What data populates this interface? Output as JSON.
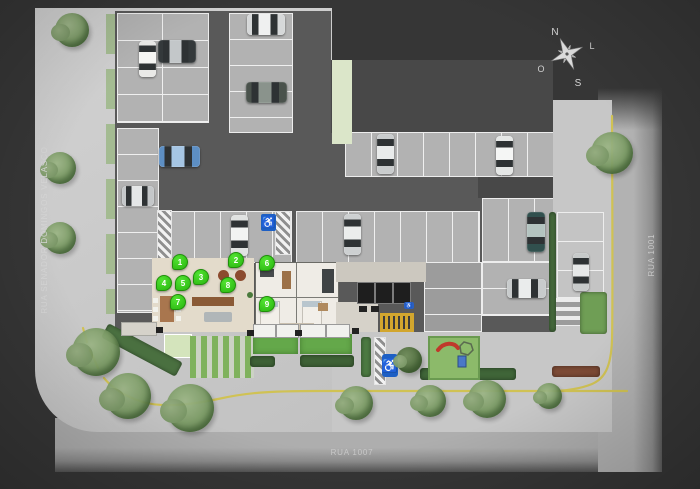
{
  "streets": {
    "left": "RUA SENADOR DOMINGOS VELASCO",
    "bottom": "RUA 1007",
    "right": "RUA 1001"
  },
  "compass": {
    "north": "N",
    "south": "S",
    "east": "L",
    "west": "O"
  },
  "icons": {
    "accessibility": "♿"
  },
  "colors": {
    "marker_green": "#35c91e",
    "accessible_blue": "#1d5fc4",
    "lane_yellow": "#d0c254",
    "stair_yellow": "#d2a62e",
    "lawn_green": "#64a84a",
    "slide_red": "#c0392b",
    "building_gray": "#595959",
    "sidewalk_gray": "#c7c7c7"
  },
  "markers": [
    {
      "label": "1",
      "x": 179,
      "y": 261
    },
    {
      "label": "2",
      "x": 235,
      "y": 259
    },
    {
      "label": "3",
      "x": 200,
      "y": 276
    },
    {
      "label": "4",
      "x": 163,
      "y": 282
    },
    {
      "label": "5",
      "x": 182,
      "y": 282
    },
    {
      "label": "6",
      "x": 266,
      "y": 262
    },
    {
      "label": "7",
      "x": 177,
      "y": 301
    },
    {
      "label": "8",
      "x": 227,
      "y": 284
    },
    {
      "label": "9",
      "x": 266,
      "y": 303
    }
  ],
  "cars": [
    {
      "x": 139,
      "y": 41,
      "w": 17,
      "h": 36,
      "dir": "v",
      "body": "#e9e9e7",
      "roof": "#f5f5f3"
    },
    {
      "x": 158,
      "y": 40,
      "w": 38,
      "h": 23,
      "dir": "h",
      "body": "#34393b",
      "roof": "#c3c7c9"
    },
    {
      "x": 247,
      "y": 14,
      "w": 38,
      "h": 21,
      "dir": "h",
      "body": "#d6d8d9",
      "roof": "#eff0f0"
    },
    {
      "x": 246,
      "y": 82,
      "w": 41,
      "h": 21,
      "dir": "h",
      "body": "#4a524c",
      "roof": "#8a938c"
    },
    {
      "x": 159,
      "y": 146,
      "w": 41,
      "h": 21,
      "dir": "h",
      "body": "#5d8fc4",
      "roof": "#a6c6e4"
    },
    {
      "x": 122,
      "y": 186,
      "w": 32,
      "h": 20,
      "dir": "h",
      "body": "#c4c7c9",
      "roof": "#e4e6e7"
    },
    {
      "x": 231,
      "y": 215,
      "w": 17,
      "h": 41,
      "dir": "v",
      "body": "#e0e2e1",
      "roof": "#f2f3f2"
    },
    {
      "x": 344,
      "y": 214,
      "w": 17,
      "h": 41,
      "dir": "v",
      "body": "#cdd0d1",
      "roof": "#ebedec"
    },
    {
      "x": 377,
      "y": 134,
      "w": 17,
      "h": 40,
      "dir": "v",
      "body": "#c9cccd",
      "roof": "#e9ebeb"
    },
    {
      "x": 496,
      "y": 136,
      "w": 17,
      "h": 39,
      "dir": "v",
      "body": "#e5e7e6",
      "roof": "#f5f6f5"
    },
    {
      "x": 527,
      "y": 212,
      "w": 18,
      "h": 40,
      "dir": "v",
      "body": "#31504e",
      "roof": "#b4c4c0"
    },
    {
      "x": 507,
      "y": 279,
      "w": 39,
      "h": 19,
      "dir": "h",
      "body": "#c8cbcc",
      "roof": "#eaecec"
    },
    {
      "x": 573,
      "y": 253,
      "w": 16,
      "h": 38,
      "dir": "v",
      "body": "#c7caca",
      "roof": "#e6e8e8"
    }
  ],
  "trees": [
    {
      "x": 72,
      "y": 30,
      "r": 17
    },
    {
      "x": 60,
      "y": 168,
      "r": 16
    },
    {
      "x": 60,
      "y": 238,
      "r": 16
    },
    {
      "x": 96,
      "y": 352,
      "r": 24
    },
    {
      "x": 128,
      "y": 396,
      "r": 23
    },
    {
      "x": 190,
      "y": 408,
      "r": 24
    },
    {
      "x": 356,
      "y": 403,
      "r": 17
    },
    {
      "x": 430,
      "y": 401,
      "r": 16
    },
    {
      "x": 487,
      "y": 399,
      "r": 19
    },
    {
      "x": 549,
      "y": 396,
      "r": 13
    },
    {
      "x": 612,
      "y": 153,
      "r": 21
    },
    {
      "x": 409,
      "y": 360,
      "r": 13,
      "dark": true
    }
  ]
}
